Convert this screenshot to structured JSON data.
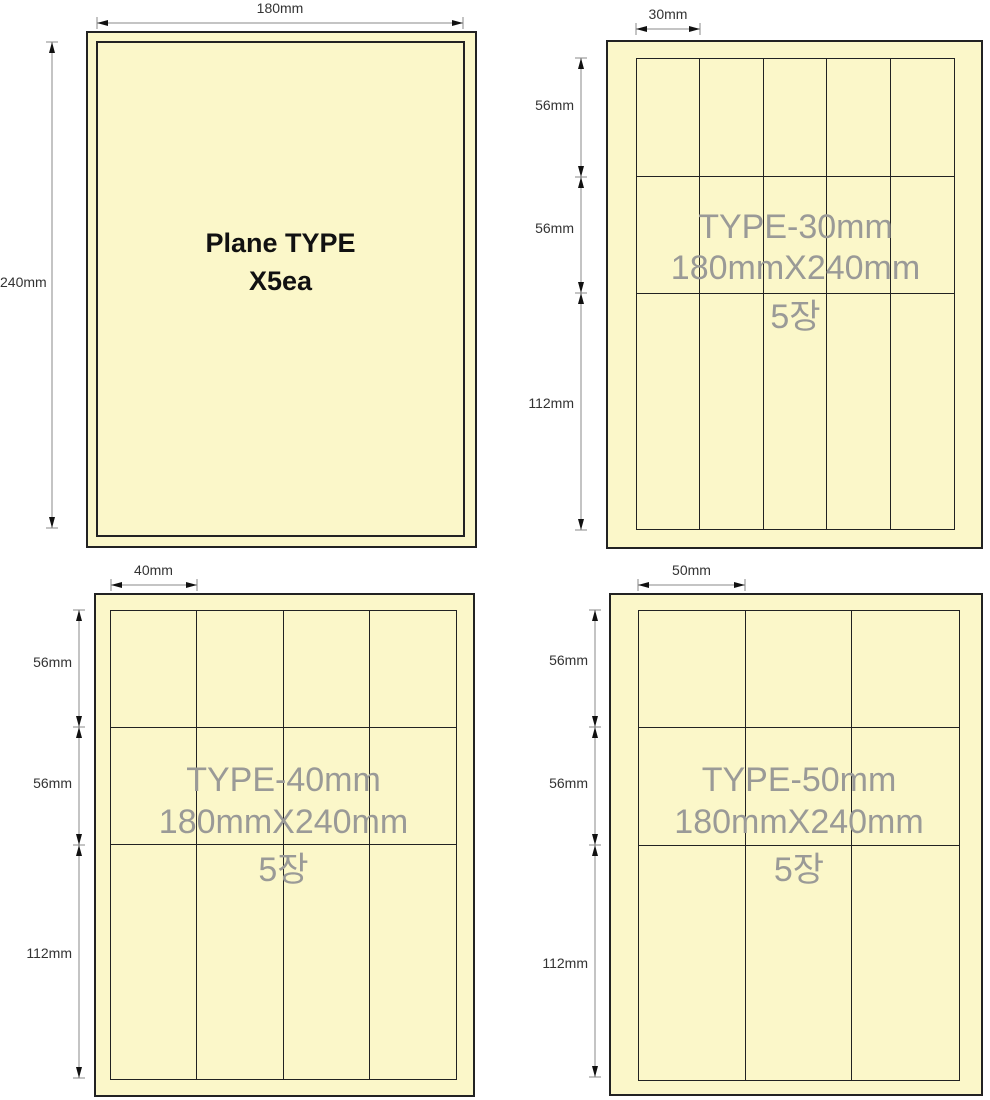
{
  "colors": {
    "background": "#ffffff",
    "sheet_fill": "#fbf7c9",
    "outline": "#222222",
    "dimension_line": "#888888",
    "arrow": "#111111",
    "dim_text": "#333333",
    "watermark_text": "#9a9a97",
    "title_text": "#111111"
  },
  "diagrams": [
    {
      "id": "plane-type",
      "title_line1": "Plane TYPE",
      "title_line2": "X5ea",
      "width_dim": "180mm",
      "height_dim": "240mm"
    },
    {
      "id": "type-30mm",
      "watermark_line1": "TYPE-30mm",
      "watermark_line2": "180mmX240mm",
      "watermark_line3": "5장",
      "cell_width_dim": "30mm",
      "row_dims": [
        "56mm",
        "56mm",
        "112mm"
      ],
      "row_heights_mm": [
        56,
        56,
        112
      ],
      "columns": 5,
      "rows": 3
    },
    {
      "id": "type-40mm",
      "watermark_line1": "TYPE-40mm",
      "watermark_line2": "180mmX240mm",
      "watermark_line3": "5장",
      "cell_width_dim": "40mm",
      "row_dims": [
        "56mm",
        "56mm",
        "112mm"
      ],
      "row_heights_mm": [
        56,
        56,
        112
      ],
      "columns": 4,
      "rows": 3
    },
    {
      "id": "type-50mm",
      "watermark_line1": "TYPE-50mm",
      "watermark_line2": "180mmX240mm",
      "watermark_line3": "5장",
      "cell_width_dim": "50mm",
      "row_dims": [
        "56mm",
        "56mm",
        "112mm"
      ],
      "row_heights_mm": [
        56,
        56,
        112
      ],
      "columns": 3,
      "rows": 3
    }
  ]
}
